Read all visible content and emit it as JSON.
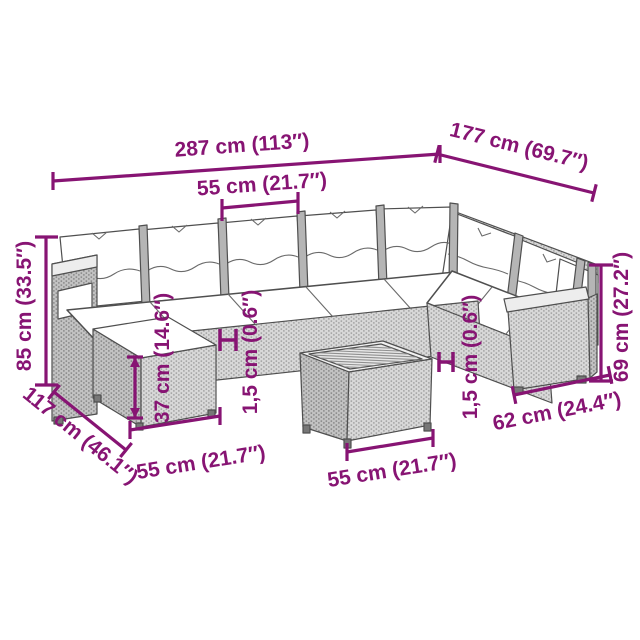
{
  "diagram": {
    "type": "product-dimension-diagram",
    "subject": "rattan garden lounge set with corner sofa, footstool and coffee table"
  },
  "colors": {
    "annotation": "#871473",
    "background": "#ffffff",
    "furniture_outline": "#4f4f4f",
    "rattan_light": "#d8d8d8",
    "rattan_dark": "#c2c2c2",
    "cushion": "#ffffff"
  },
  "dimensions": {
    "overall_width": "287 cm (113″)",
    "overall_depth": "177 cm (69.7″)",
    "seat_width": "55 cm (21.7″)",
    "overall_height": "85 cm (33.5″)",
    "side_depth": "117 cm (46.1″)",
    "footstool_width": "55 cm (21.7″)",
    "footstool_height": "37 cm (14.6″)",
    "cushion_thickness_left": "1,5 cm (0.6″)",
    "table_width": "55 cm (21.7″)",
    "cushion_thickness_right": "1,5 cm (0.6″)",
    "armrest_height": "69 cm (27.2″)",
    "end_section_width": "62 cm (24.4″)"
  }
}
